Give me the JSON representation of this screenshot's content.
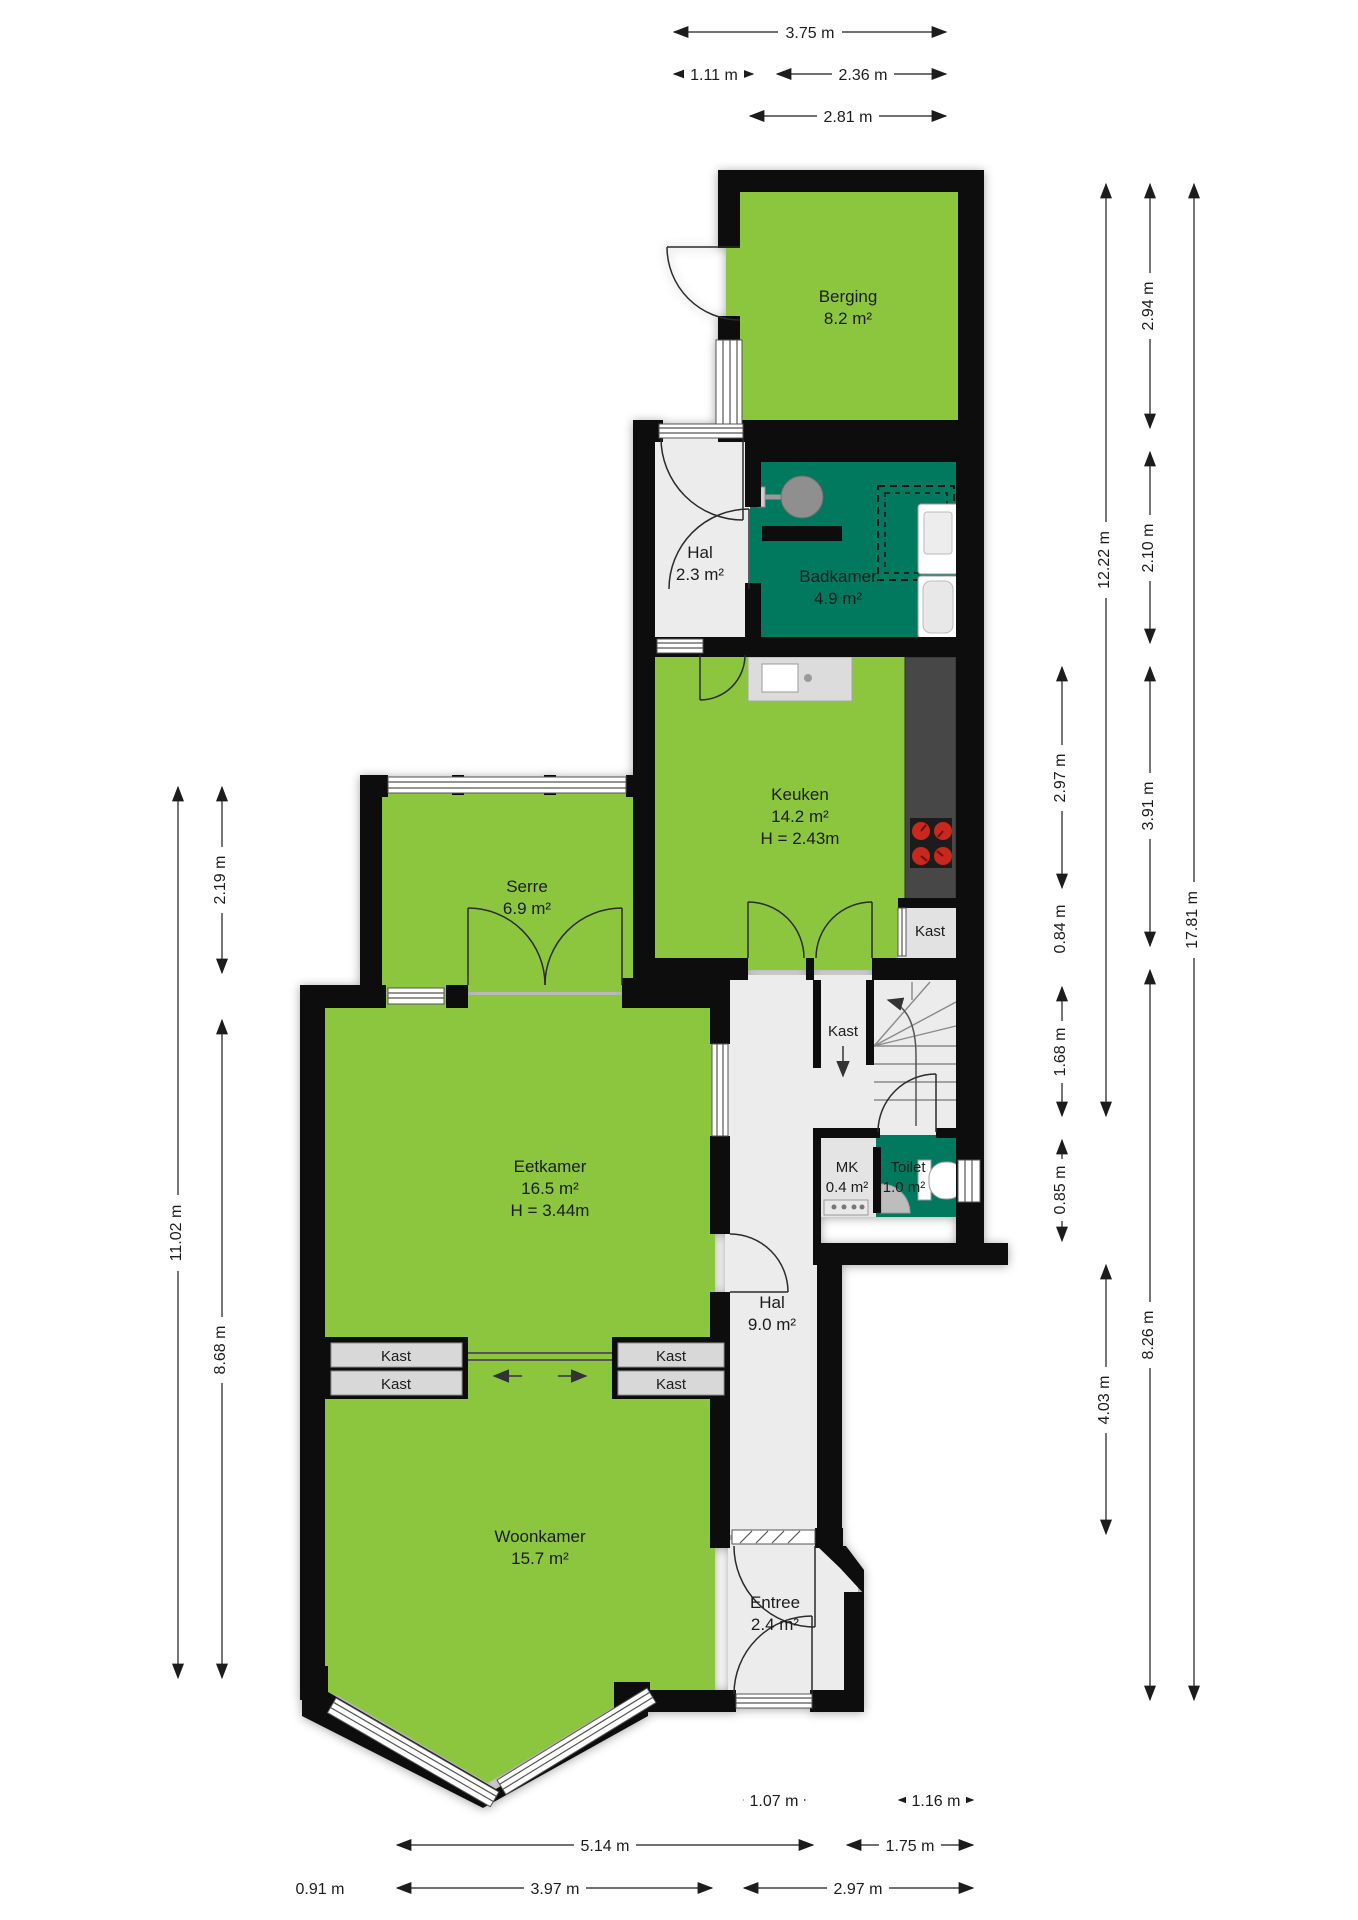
{
  "title": "Floor plan (begane grond)",
  "rooms": {
    "berging": {
      "name": "Berging",
      "area": "8.2 m²"
    },
    "hal_boven": {
      "name": "Hal",
      "area": "2.3 m²"
    },
    "badkamer": {
      "name": "Badkamer",
      "area": "4.9 m²"
    },
    "keuken": {
      "name": "Keuken",
      "area": "14.2 m²",
      "height": "H = 2.43m"
    },
    "serre": {
      "name": "Serre",
      "area": "6.9 m²"
    },
    "eetkamer": {
      "name": "Eetkamer",
      "area": "16.5 m²",
      "height": "H = 3.44m"
    },
    "hal": {
      "name": "Hal",
      "area": "9.0 m²"
    },
    "mk": {
      "name": "MK",
      "area": "0.4 m²"
    },
    "toilet": {
      "name": "Toilet",
      "area": "1.0 m²"
    },
    "woonkamer": {
      "name": "Woonkamer",
      "area": "15.7 m²"
    },
    "entree": {
      "name": "Entree",
      "area": "2.4 m²"
    }
  },
  "closets": {
    "kast_keuken": "Kast",
    "kast_trap": "Kast",
    "kast_links_1": "Kast",
    "kast_links_2": "Kast",
    "kast_rechts_1": "Kast",
    "kast_rechts_2": "Kast"
  },
  "dimensions": {
    "d375": {
      "label": "3.75 m"
    },
    "d111": {
      "label": "1.11 m"
    },
    "d236": {
      "label": "2.36 m"
    },
    "d281": {
      "label": "2.81 m"
    },
    "d294": {
      "label": "2.94 m"
    },
    "d210": {
      "label": "2.10 m"
    },
    "d391": {
      "label": "3.91 m"
    },
    "d826": {
      "label": "8.26 m"
    },
    "d297r": {
      "label": "2.97 m"
    },
    "d084": {
      "label": "0.84 m"
    },
    "d168": {
      "label": "1.68 m"
    },
    "d085": {
      "label": "0.85 m"
    },
    "d1222": {
      "label": "12.22 m"
    },
    "d403": {
      "label": "4.03 m"
    },
    "d1781": {
      "label": "17.81 m"
    },
    "d219": {
      "label": "2.19 m"
    },
    "d1102": {
      "label": "11.02 m"
    },
    "d868": {
      "label": "8.68 m"
    },
    "d107": {
      "label": "1.07 m"
    },
    "d116": {
      "label": "1.16 m"
    },
    "d514": {
      "label": "5.14 m"
    },
    "d175": {
      "label": "1.75 m"
    },
    "d091": {
      "label": "0.91 m"
    },
    "d397": {
      "label": "3.97 m"
    },
    "d297b": {
      "label": "2.97 m"
    }
  },
  "colors": {
    "room_green": "#8CC63F",
    "wet_room_teal": "#00795F",
    "wall_black": "#0D0D0D",
    "floor_gray": "#ECECEC",
    "counter_gray": "#474747",
    "burner_red": "#C8281E"
  }
}
